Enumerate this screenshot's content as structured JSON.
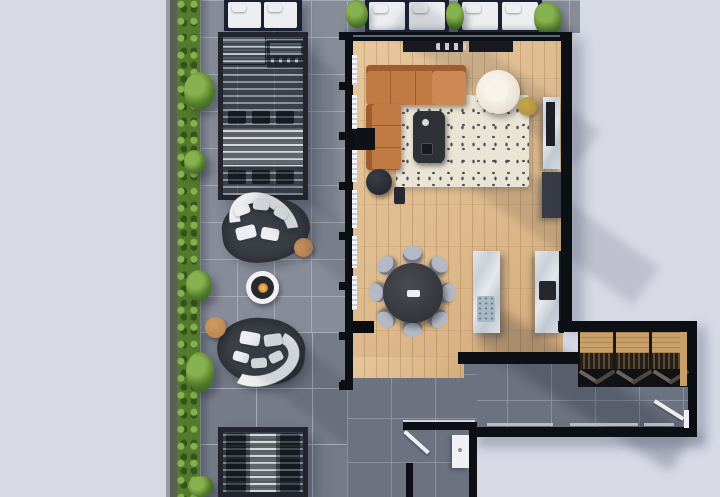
{
  "scene": {
    "type": "architectural-floorplan-render",
    "view": "top-down 3D render of a penthouse apartment with wrap-around terrace",
    "regions": [
      {
        "name": "terrace",
        "floor": "grey stone pavers",
        "edge": "green hedge planter along left side"
      },
      {
        "name": "living-room",
        "floor": "light oak plank"
      },
      {
        "name": "dining-area",
        "floor": "light oak plank"
      },
      {
        "name": "kitchen",
        "floor": "light oak plank"
      },
      {
        "name": "hallway",
        "floor": "dark grey tile"
      },
      {
        "name": "wardrobe-nook",
        "floor": "dark grey tile"
      },
      {
        "name": "bathroom",
        "floor": "dark grey tile"
      }
    ],
    "furniture": [
      "three double sunbeds with planters along top edge",
      "pergola with outdoor kitchen grill and eight-seat outdoor dining table",
      "two curved white outdoor sofas on dark round rugs with round timber side tables",
      "round fire pit with flame",
      "second pergola with two loungers and stone table",
      "cognac L-shaped tufted sectional sofa",
      "cream patterned area rug with dark coffee table",
      "cream boucle swivel armchair and olive pouf",
      "black floor lamp",
      "round dark dining table with eight grey chairs",
      "marble kitchen island with sink",
      "marble counter with cooktop",
      "marble fireplace column and media console",
      "open wardrobe with hanging clothes and folding doors",
      "white bathroom vanity and swing doors"
    ]
  },
  "palette": {
    "bg": "#d7d9e5",
    "paver": "#878c98",
    "paverDark": "#767b88",
    "paverLine": "#a7adb8",
    "hedge": "#537b2b",
    "hedgeLight": "#85b24e",
    "hedgeDark": "#35521a",
    "planter": "#5c6054",
    "planterEdge": "#9599a2",
    "wall": "#0c0f14",
    "woodA": "#e7c79c",
    "woodB": "#ddb98b",
    "woodC": "#d2ab7b",
    "tile": "#6d7280",
    "tileLine": "#8b919e",
    "pergolaFrame": "#22252d",
    "rugDark": "#3b3f46",
    "rugCream": "#e9e4d4",
    "rugMark": "#4c4c56",
    "white": "#eceef1",
    "cognac": "#c27a45",
    "cognacDark": "#a05c2c",
    "cognacLight": "#cd8854",
    "charcoal": "#2e3136",
    "tan": "#d19a63",
    "flame": "#e0953a",
    "chairGray": "#b3bac6",
    "chairDark": "#24272d",
    "navyBase": "#1b2130",
    "olive": "#ac8d3a",
    "closetWood": "#c89f68",
    "clothesDark": "#261f18",
    "glass": "#7e93a6",
    "threshold": "#c6cad2",
    "steelTop": "#b8c1cb"
  }
}
